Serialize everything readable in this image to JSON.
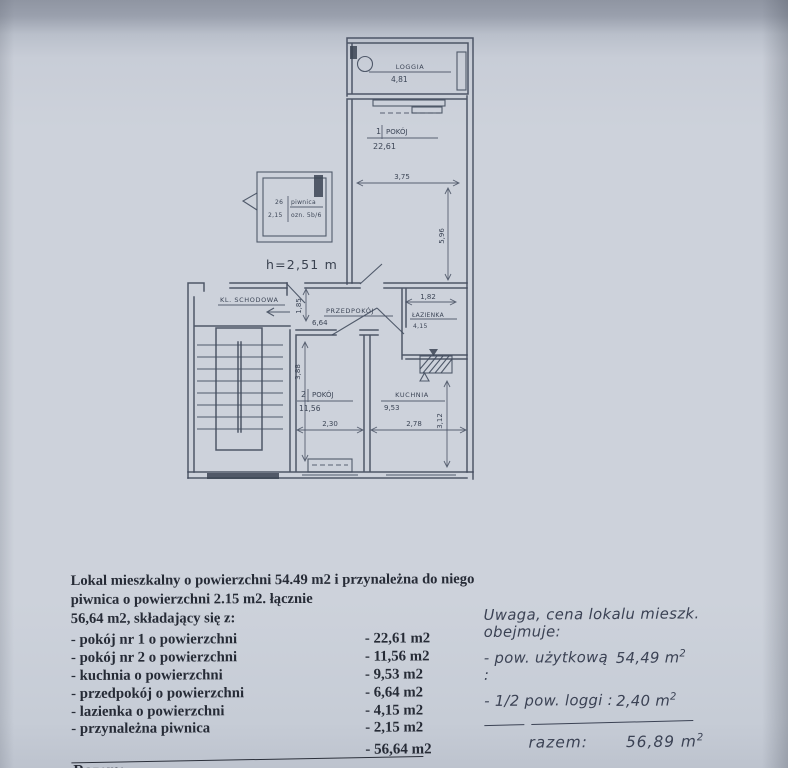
{
  "page": {
    "paper_color": "#cdd2db",
    "ink_color": "#3c4556"
  },
  "plan": {
    "labels": {
      "loggia": "LOGGIA",
      "loggia_area": "4,81",
      "room1_no": "1",
      "room1_name": "POKÓJ",
      "room1_area": "22,61",
      "piwnica_no": "26",
      "piwnica_name": "piwnica",
      "piwnica_area": "2,15",
      "piwnica_note": "ozn. 5b/6",
      "height_note": "h=2,51 m",
      "stairs": "KL. SCHODOWA",
      "hall": "PRZEDPOKÓJ",
      "hall_area": "6,64",
      "bath": "ŁAZIENKA",
      "bath_area": "4,15",
      "room2_no": "2",
      "room2_name": "POKÓJ",
      "room2_area": "11,56",
      "kitchen": "KUCHNIA",
      "kitchen_area": "9,53"
    },
    "dims": {
      "room1_w": "3,75",
      "room1_h": "5,96",
      "hall_w": "1,85",
      "bath_w": "1,82",
      "room2_h": "3,88",
      "room2_w": "2,30",
      "kitchen_w": "2,78",
      "kitchen_h": "3,12"
    }
  },
  "description": {
    "intro_line1": "Lokal mieszkalny o powierzchni 54.49 m2 i przynależna do niego piwnica o powierzchni 2.15 m2. łącznie",
    "intro_line2": "56,64 m2, składający się z:",
    "items": [
      {
        "label": "- pokój nr 1 o powierzchni",
        "value": "- 22,61 m2"
      },
      {
        "label": "- pokój nr 2 o powierzchni",
        "value": "- 11,56 m2"
      },
      {
        "label": "- kuchnia o powierzchni",
        "value": "- 9,53 m2"
      },
      {
        "label": "- przedpokój o powierzchni",
        "value": "- 6,64  m2"
      },
      {
        "label": "- lazienka o powierzchni",
        "value": "- 4,15  m2"
      },
      {
        "label": "- przynależna piwnica",
        "value": "- 2,15  m2"
      }
    ],
    "total_label": "Razem:",
    "total_value": "- 56,64 m2"
  },
  "note": {
    "line1": "Uwaga, cena lokalu mieszk. obejmuje:",
    "row1_label": "- pow. użytkową :",
    "row1_value": "54,49 m",
    "row1_sup": "2",
    "row2_label": "- 1/2 pow. loggi :",
    "row2_value": "2,40 m",
    "row2_sup": "2",
    "total_label": "razem:",
    "total_value": "56,89 m",
    "total_sup": "2"
  }
}
